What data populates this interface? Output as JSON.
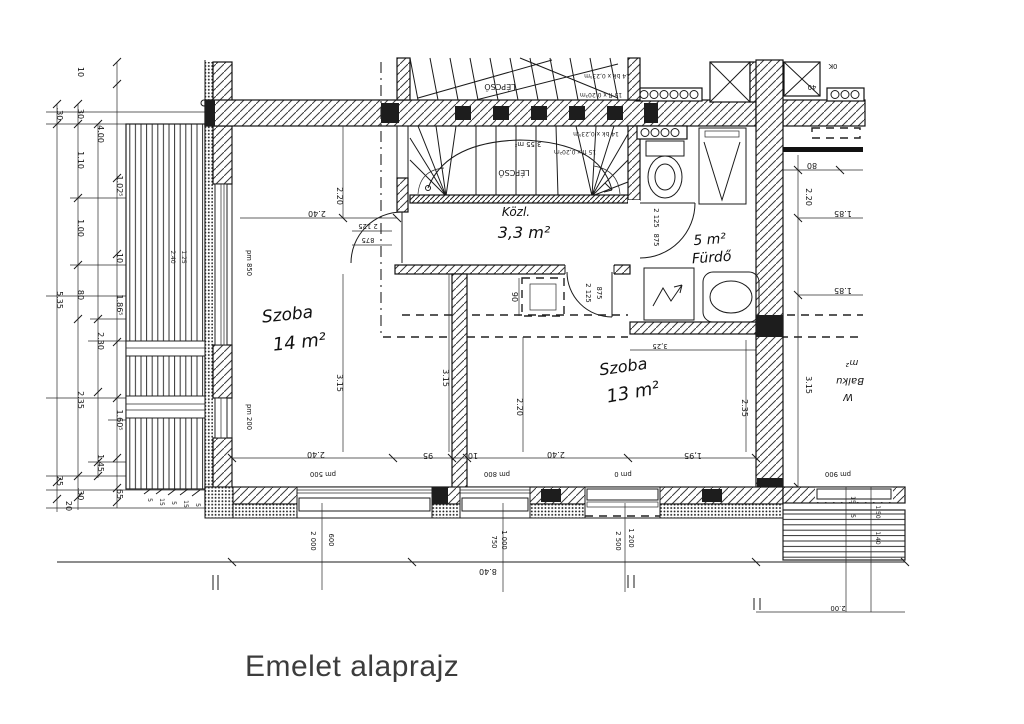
{
  "title": "Emelet alaprajz",
  "rooms": {
    "szoba14": {
      "name": "Szoba",
      "area": "14 m²"
    },
    "szoba13": {
      "name": "Szoba",
      "area": "13 m²"
    },
    "kozlekedo": {
      "name": "Közl.",
      "area": "3,3 m²"
    },
    "furdo": {
      "name": "Fürdő",
      "area": "5 m²"
    },
    "cropped_right": [
      "m²",
      "Balku",
      "W"
    ]
  },
  "stairs": {
    "label": "LÉPCSŐ",
    "area": "3,55 m²",
    "specs": [
      "14 bk x 0,23⁵m",
      "15 fl x 0,20³m",
      "14 bk x 0,23⁵m",
      "15 fl x 0,20²m"
    ]
  },
  "icons": {
    "toilet": "wc-top-view",
    "shower": "shower-tray-triangle",
    "washbasin": "basin-oval",
    "washer_mark": "hand-drawn-arrow",
    "radiator": "radiator-coil",
    "shaft": "crossed-box"
  },
  "dims": {
    "left_a": [
      ".30",
      "5.35",
      "25",
      "20"
    ],
    "left_b": [
      "30",
      "1.10",
      "1.00",
      "80",
      "2.35",
      ".30"
    ],
    "left_c": [
      "4.00",
      "2.30",
      "1.45"
    ],
    "left_d": [
      "10",
      "1.02⁵",
      "10",
      "1.86⁵",
      "1.60⁵",
      "65"
    ],
    "left_small": [
      "5",
      "15",
      "5",
      "15",
      "5"
    ],
    "balcony_left": [
      "2.40",
      "1.25"
    ],
    "interior_bottom": [
      "2.40",
      "95",
      "10",
      "2.40",
      "1,95"
    ],
    "door14": {
      "w": "2.40",
      "h1": "2 125",
      "h2": "875"
    },
    "door_bath": [
      "2 125",
      "875"
    ],
    "door_13": [
      "2 125",
      "875"
    ],
    "vertical": {
      "v220a": "2.20",
      "v315a": "3.15",
      "v315b": "3.15",
      "v220b": "2.20",
      "v235": "2.35",
      "v315r": "3.15",
      "v220r": "2.20",
      "niche": "90"
    },
    "bath_top": "3,25",
    "right": {
      "r80": "80",
      "r185a": "1.85",
      "r185b": "1.85",
      "r40": "40",
      "top": "0K"
    },
    "pm": {
      "left_up": "pm 850",
      "left_low": "pm 200",
      "w1": "pm 500",
      "w2": "pm 800",
      "w3": "pm 0",
      "w4": "pm 900"
    },
    "win1": [
      "2 000",
      "600"
    ],
    "win2": [
      "750",
      "1 000"
    ],
    "win3": [
      "2 500",
      "1 200"
    ],
    "overall": "8.40",
    "right_small": [
      "15",
      "5",
      "1 50",
      "1 40",
      "2.00"
    ]
  }
}
